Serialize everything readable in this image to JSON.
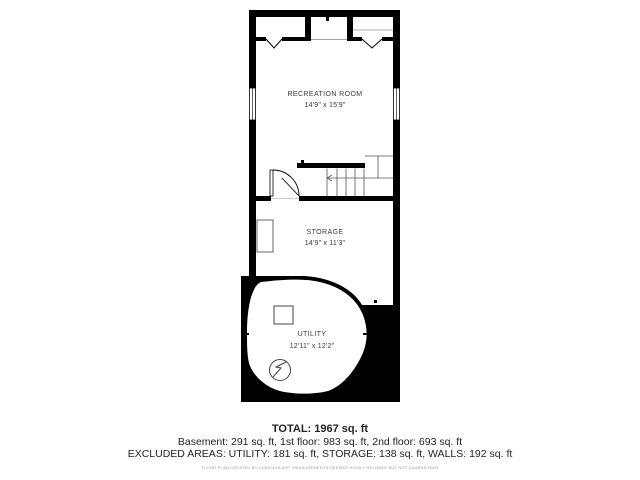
{
  "plan": {
    "rooms": [
      {
        "name": "RECREATION ROOM",
        "dims": "14'9\" x 15'9\""
      },
      {
        "name": "STORAGE",
        "dims": "14'9\" x 11'3\""
      },
      {
        "name": "UTILITY",
        "dims": "12'11\" x 12'2\""
      }
    ],
    "features": [
      "closet-bifold-left",
      "closet-bifold-right",
      "stairs",
      "door",
      "window-left",
      "window-right",
      "furnace-square",
      "water-heater-circle"
    ]
  },
  "summary": {
    "total": "TOTAL: 1967 sq. ft",
    "floors": "Basement: 291 sq. ft, 1st floor: 983 sq. ft, 2nd floor: 693 sq. ft",
    "excluded": "EXCLUDED AREAS: UTILITY: 181 sq. ft, STORAGE: 138 sq. ft, WALLS: 192 sq. ft",
    "disclaimer": "FLOOR PLAN CREATED BY CUBICASA APP. MEASUREMENTS DEEMED HIGHLY RELIABLE BUT NOT GUARANTEED"
  },
  "colors": {
    "wall": "#000000",
    "room_fill": "#ffffff",
    "label": "#3a3a3a",
    "thin_line": "#555555",
    "summary_text": "#232323",
    "disclaimer_text": "#9a9a9a"
  }
}
